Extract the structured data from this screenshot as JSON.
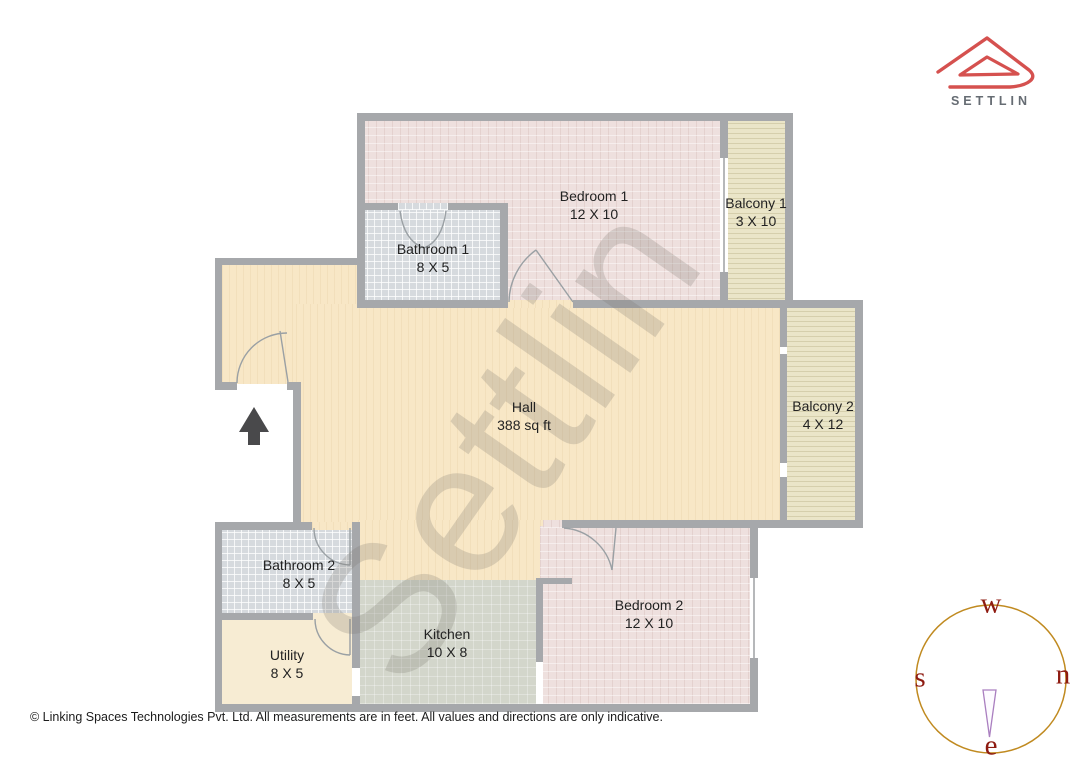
{
  "logo": {
    "brand": "SETTLIN",
    "roof_color": "#d5514f",
    "text_color": "#666c73"
  },
  "watermark": {
    "text": "Settlin"
  },
  "plan": {
    "rooms": [
      {
        "id": "bedroom-1",
        "name": "Bedroom 1",
        "dims": "12 X 10"
      },
      {
        "id": "balcony-1",
        "name": "Balcony 1",
        "dims": "3 X 10"
      },
      {
        "id": "bathroom-1",
        "name": "Bathroom 1",
        "dims": "8 X 5"
      },
      {
        "id": "hall",
        "name": "Hall",
        "dims": "388 sq ft"
      },
      {
        "id": "balcony-2",
        "name": "Balcony 2",
        "dims": "4 X 12"
      },
      {
        "id": "bathroom-2",
        "name": "Bathroom 2",
        "dims": "8 X 5"
      },
      {
        "id": "utility",
        "name": "Utility",
        "dims": "8 X 5"
      },
      {
        "id": "kitchen",
        "name": "Kitchen",
        "dims": "10 X 8"
      },
      {
        "id": "bedroom-2",
        "name": "Bedroom 2",
        "dims": "12 X 10"
      }
    ],
    "colors": {
      "wall": "#a6a8ab",
      "hall_floor": "#f8e7c6",
      "bedroom_floor": "#eee0de",
      "bathroom_floor": "#d6dade",
      "balcony_floor": "#eae5c8",
      "kitchen_floor": "#d3d6cb",
      "utility_floor": "#f7ecd3"
    }
  },
  "compass": {
    "top": "w",
    "left": "s",
    "right": "n",
    "bottom": "e",
    "ring_color": "#c08a20",
    "letter_color": "#8e1b11",
    "needle_color": "#aa7fc0"
  },
  "footer": {
    "text": "© Linking Spaces Technologies Pvt. Ltd. All measurements are in feet. All values and directions are only indicative."
  }
}
